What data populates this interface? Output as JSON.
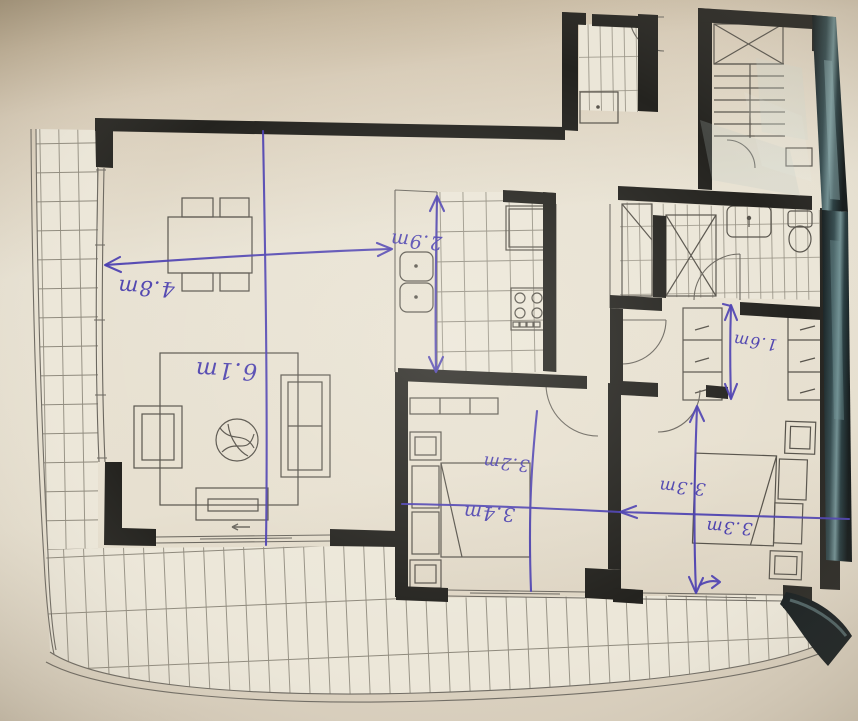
{
  "colors": {
    "background_beige": "#cfc2ac",
    "paper": "#e8e2d3",
    "wall_black": "#24231f",
    "plan_line_gray": "#6b675f",
    "handwriting_ink_blue": "#4a3eb0",
    "glossy_edge_dark": "#141a1c",
    "glare_teal": "#7d9a9c"
  },
  "ink_annotations": {
    "living_width_arrow": "4.8m",
    "living_length_note": "6.1m",
    "kitchen_depth_arrow": "2.9m",
    "bedroom1_width_note": "3.2m",
    "bedroom1_length_note": "3.4m",
    "bedroom2_width_note": "3.3m",
    "bedroom2_length_note": "3.3m",
    "dressing_corridor_arrow": "1.6m"
  },
  "plan_features": [
    "wrap-around-balcony",
    "living-dining-room",
    "kitchen",
    "hallway",
    "bedroom-1",
    "bedroom-2",
    "ensuite-bathroom",
    "shower",
    "wardrobes",
    "laundry-closet",
    "entry-door",
    "stairwell"
  ]
}
